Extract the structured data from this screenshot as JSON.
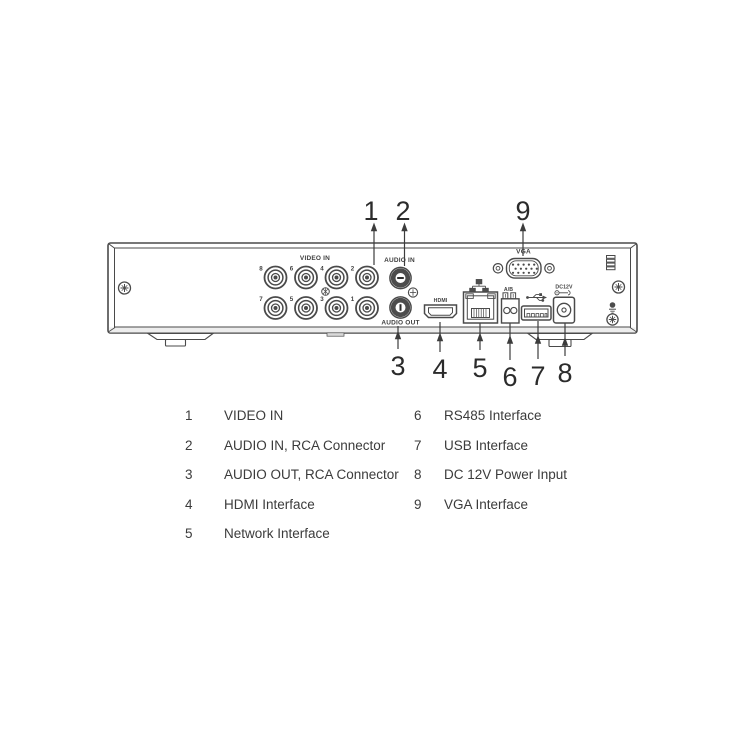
{
  "diagram": {
    "title_hint": "DVR rear panel interface diagram",
    "callout_numbers": [
      "1",
      "2",
      "3",
      "4",
      "5",
      "6",
      "7",
      "8",
      "9"
    ],
    "bnc_numbers": [
      "8",
      "6",
      "4",
      "2",
      "7",
      "5",
      "3",
      "1"
    ],
    "panel_labels": {
      "video_in": "VIDEO IN",
      "audio_in": "AUDIO IN",
      "audio_out": "AUDIO OUT",
      "hdmi": "HDMI",
      "vga": "VGA",
      "rs485": "A/B",
      "power": "DC12V"
    }
  },
  "legend": {
    "items": [
      {
        "num": "1",
        "label": "VIDEO IN"
      },
      {
        "num": "2",
        "label": "AUDIO IN, RCA Connector"
      },
      {
        "num": "3",
        "label": "AUDIO OUT, RCA Connector"
      },
      {
        "num": "4",
        "label": "HDMI Interface"
      },
      {
        "num": "5",
        "label": "Network Interface"
      },
      {
        "num": "6",
        "label": "RS485 Interface"
      },
      {
        "num": "7",
        "label": "USB Interface"
      },
      {
        "num": "8",
        "label": "DC 12V Power Input"
      },
      {
        "num": "9",
        "label": "VGA Interface"
      }
    ]
  },
  "colors": {
    "line": "#4a4a4a",
    "dark_fill": "#4d4d4d",
    "text": "#3b3b3b",
    "band": "#ededed"
  }
}
